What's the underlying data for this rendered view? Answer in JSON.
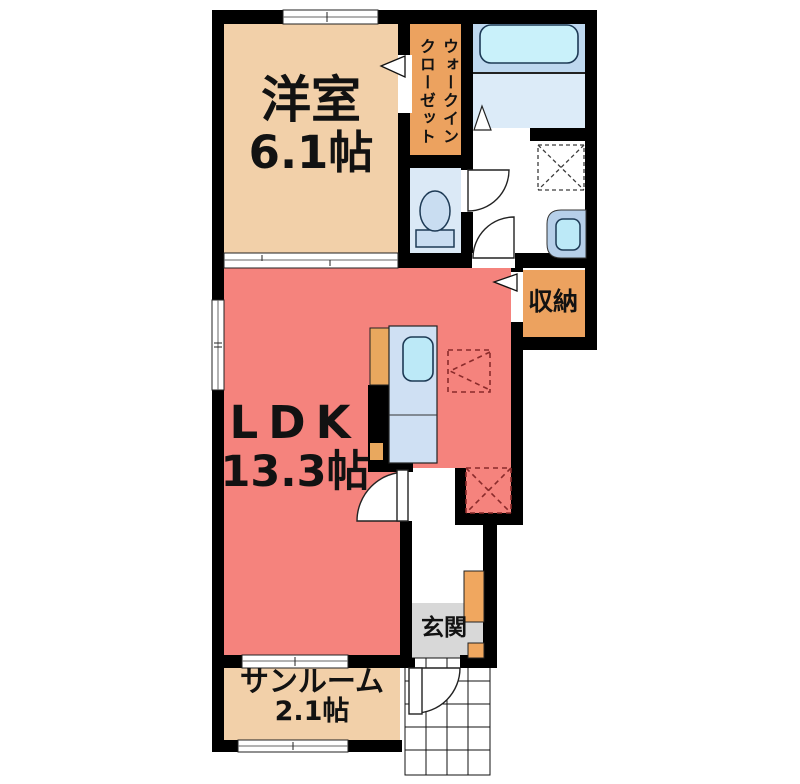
{
  "rooms": {
    "western_room": {
      "name": "洋室",
      "size": "6.1帖"
    },
    "walk_in_closet": {
      "line1": "ウォークイン",
      "line2": "クローゼット"
    },
    "storage": {
      "name": "収納"
    },
    "ldk": {
      "name": "LDK",
      "size": "13.3帖"
    },
    "sunroom": {
      "name": "サンルーム",
      "size": "2.1帖"
    },
    "entrance": {
      "name": "玄関"
    }
  },
  "colors": {
    "room_beige": "#f2d0a9",
    "closet_orange": "#eca25f",
    "ldk_salmon": "#f5837d",
    "bath_blue": "#bed8ef",
    "bath_floor": "#dcebf8",
    "tub_fill": "#c9f1fa",
    "toilet_floor": "#dbe9f6",
    "fixture_blue": "#c9ddf1",
    "sink_fill": "#bce9f7",
    "counter_blue": "#cfe0f3",
    "entrance_gray": "#d8d8d8",
    "wall_black": "#000000",
    "marker_red": "#8a2b2b"
  }
}
